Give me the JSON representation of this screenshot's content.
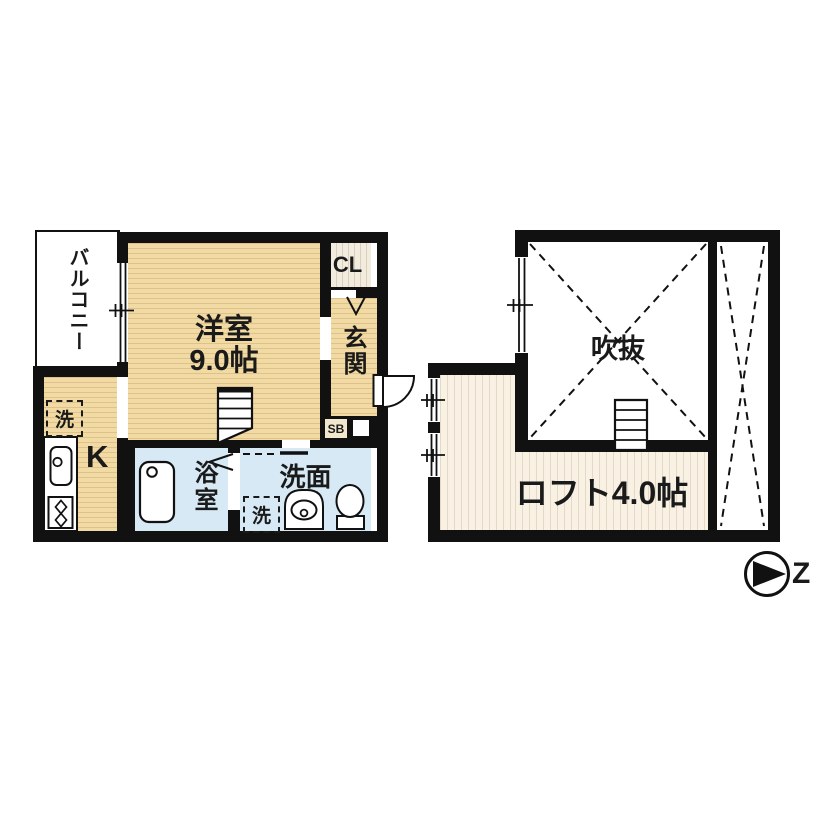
{
  "floor1": {
    "balcony_label": "バルコニー",
    "room_label": "洋室",
    "room_size_label": "9.0帖",
    "closet_label": "CL",
    "entrance_label": "玄関",
    "shoe_box_label": "SB",
    "kitchen_label": "K",
    "kitchen_washer_label": "洗",
    "bathroom_label": "浴室",
    "washroom_label": "洗面",
    "washroom_washer_label": "洗"
  },
  "floor2": {
    "void_label": "吹抜",
    "loft_label": "ロフト4.0帖"
  },
  "compass": {
    "north_label": "Z"
  },
  "colors": {
    "wall": "#111111",
    "wood_floor": "#f1daa4",
    "loft_floor": "#f8f1e4",
    "closet_floor": "#f2ecdf",
    "wet_area": "#d6e9f5",
    "shoe_box": "#f0e7cc"
  }
}
